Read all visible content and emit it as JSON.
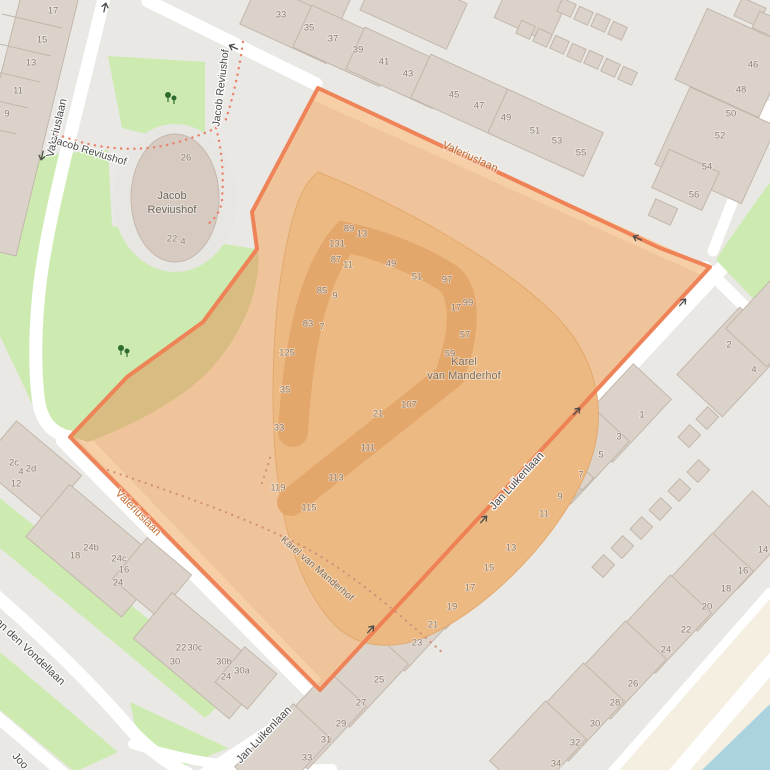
{
  "map": {
    "description": "OpenStreetMap-style map with orange highlighted area Karel van Manderhof",
    "highlighted_area_name": "Karel van Manderhof",
    "colors": {
      "background": "#e9e8e4",
      "building": "#dbd2ca",
      "building_outline": "#c3b7ab",
      "green_area": "#cdebb0",
      "water": "#aad3df",
      "road": "#ffffff",
      "cream_landuse": "#f4efe1",
      "highlight_fill": "#f0c49a",
      "highlight_parcel": "#edb983",
      "highlight_building": "#e3a76c",
      "highlight_border": "#ee7e52",
      "footpath_dots": "#e8826b",
      "street_label": "#4a4a4a",
      "street_label_highlighted": "#c06a2c",
      "house_number": "#8e7d6b"
    },
    "street_labels": {
      "valeriuslaan_west": "Valeriuslaan",
      "valeriuslaan_top": "Valeriuslaan",
      "valeriuslaan_southwest": "Valeriuslaan",
      "jacob_reviushof_path": "Jacob Reviushof",
      "jacob_reviushof_path_vertical": "Jacob Reviushof",
      "jan_luikenlaan_northeast": "Jan Luikenlaan",
      "jan_luikenlaan_south": "Jan Luikenlaan",
      "an_den_vondellaan": "an den Vondellaan",
      "joost_partial": "Joo"
    },
    "place_labels": {
      "jacob_reviushof": {
        "line1": "Jacob",
        "line2": "Reviushof"
      },
      "karel_van_manderhof": {
        "line1": "Karel",
        "line2": "van Manderhof"
      },
      "karel_van_manderhof_path": "Karel van Manderhof"
    },
    "house_numbers": [
      {
        "t": "17",
        "x": 53,
        "y": 11
      },
      {
        "t": "15",
        "x": 42,
        "y": 40
      },
      {
        "t": "13",
        "x": 31,
        "y": 63
      },
      {
        "t": "11",
        "x": 18,
        "y": 91
      },
      {
        "t": "9",
        "x": 7,
        "y": 114
      },
      {
        "t": "33",
        "x": 281,
        "y": 15
      },
      {
        "t": "35",
        "x": 309,
        "y": 28
      },
      {
        "t": "37",
        "x": 333,
        "y": 39
      },
      {
        "t": "39",
        "x": 358,
        "y": 50
      },
      {
        "t": "41",
        "x": 384,
        "y": 62
      },
      {
        "t": "43",
        "x": 408,
        "y": 74
      },
      {
        "t": "45",
        "x": 454,
        "y": 95
      },
      {
        "t": "47",
        "x": 479,
        "y": 106
      },
      {
        "t": "49",
        "x": 506,
        "y": 118
      },
      {
        "t": "51",
        "x": 535,
        "y": 131
      },
      {
        "t": "53",
        "x": 557,
        "y": 141
      },
      {
        "t": "55",
        "x": 581,
        "y": 153
      },
      {
        "t": "46",
        "x": 753,
        "y": 65
      },
      {
        "t": "48",
        "x": 741,
        "y": 90
      },
      {
        "t": "50",
        "x": 731,
        "y": 114
      },
      {
        "t": "52",
        "x": 720,
        "y": 136
      },
      {
        "t": "54",
        "x": 707,
        "y": 167
      },
      {
        "t": "56",
        "x": 694,
        "y": 195
      },
      {
        "t": "26",
        "x": 186,
        "y": 158
      },
      {
        "t": "22",
        "x": 172,
        "y": 239
      },
      {
        "t": "4",
        "x": 183,
        "y": 242
      },
      {
        "t": "89",
        "x": 349,
        "y": 229
      },
      {
        "t": "13",
        "x": 362,
        "y": 234
      },
      {
        "t": "131",
        "x": 337,
        "y": 244
      },
      {
        "t": "87",
        "x": 336,
        "y": 260
      },
      {
        "t": "11",
        "x": 348,
        "y": 265
      },
      {
        "t": "49",
        "x": 391,
        "y": 264
      },
      {
        "t": "51",
        "x": 417,
        "y": 277
      },
      {
        "t": "97",
        "x": 447,
        "y": 280
      },
      {
        "t": "99",
        "x": 468,
        "y": 303
      },
      {
        "t": "17",
        "x": 456,
        "y": 308
      },
      {
        "t": "85",
        "x": 322,
        "y": 291
      },
      {
        "t": "9",
        "x": 335,
        "y": 296
      },
      {
        "t": "57",
        "x": 465,
        "y": 335
      },
      {
        "t": "83",
        "x": 308,
        "y": 324
      },
      {
        "t": "7",
        "x": 322,
        "y": 327
      },
      {
        "t": "125",
        "x": 287,
        "y": 353
      },
      {
        "t": "59",
        "x": 450,
        "y": 354
      },
      {
        "t": "35",
        "x": 285,
        "y": 390
      },
      {
        "t": "33",
        "x": 279,
        "y": 428
      },
      {
        "t": "107",
        "x": 409,
        "y": 405
      },
      {
        "t": "21",
        "x": 378,
        "y": 414
      },
      {
        "t": "111",
        "x": 368,
        "y": 448
      },
      {
        "t": "113",
        "x": 336,
        "y": 478
      },
      {
        "t": "119",
        "x": 278,
        "y": 488
      },
      {
        "t": "115",
        "x": 309,
        "y": 508
      },
      {
        "t": "2c",
        "x": 14,
        "y": 463
      },
      {
        "t": "4",
        "x": 21,
        "y": 472
      },
      {
        "t": "2d",
        "x": 31,
        "y": 469
      },
      {
        "t": "12",
        "x": 16,
        "y": 484
      },
      {
        "t": "24b",
        "x": 91,
        "y": 548
      },
      {
        "t": "18",
        "x": 75,
        "y": 556
      },
      {
        "t": "24c",
        "x": 119,
        "y": 559
      },
      {
        "t": "16",
        "x": 124,
        "y": 570
      },
      {
        "t": "24",
        "x": 118,
        "y": 583
      },
      {
        "t": "22",
        "x": 181,
        "y": 648
      },
      {
        "t": "30c",
        "x": 195,
        "y": 648
      },
      {
        "t": "30",
        "x": 175,
        "y": 662
      },
      {
        "t": "30b",
        "x": 224,
        "y": 662
      },
      {
        "t": "30a",
        "x": 242,
        "y": 671
      },
      {
        "t": "24",
        "x": 226,
        "y": 677
      },
      {
        "t": "2",
        "x": 729,
        "y": 345
      },
      {
        "t": "4",
        "x": 754,
        "y": 370
      },
      {
        "t": "1",
        "x": 642,
        "y": 415
      },
      {
        "t": "3",
        "x": 619,
        "y": 437
      },
      {
        "t": "5",
        "x": 601,
        "y": 455
      },
      {
        "t": "7",
        "x": 581,
        "y": 475
      },
      {
        "t": "9",
        "x": 560,
        "y": 497
      },
      {
        "t": "11",
        "x": 544,
        "y": 514
      },
      {
        "t": "13",
        "x": 511,
        "y": 548
      },
      {
        "t": "15",
        "x": 489,
        "y": 568
      },
      {
        "t": "17",
        "x": 470,
        "y": 588
      },
      {
        "t": "19",
        "x": 452,
        "y": 607
      },
      {
        "t": "21",
        "x": 433,
        "y": 625
      },
      {
        "t": "23",
        "x": 417,
        "y": 643
      },
      {
        "t": "25",
        "x": 379,
        "y": 680
      },
      {
        "t": "27",
        "x": 361,
        "y": 703
      },
      {
        "t": "29",
        "x": 341,
        "y": 724
      },
      {
        "t": "31",
        "x": 326,
        "y": 740
      },
      {
        "t": "33",
        "x": 307,
        "y": 758
      },
      {
        "t": "14",
        "x": 763,
        "y": 550
      },
      {
        "t": "16",
        "x": 743,
        "y": 571
      },
      {
        "t": "18",
        "x": 726,
        "y": 589
      },
      {
        "t": "20",
        "x": 707,
        "y": 607
      },
      {
        "t": "22",
        "x": 686,
        "y": 630
      },
      {
        "t": "24",
        "x": 666,
        "y": 650
      },
      {
        "t": "26",
        "x": 633,
        "y": 684
      },
      {
        "t": "28",
        "x": 615,
        "y": 703
      },
      {
        "t": "30",
        "x": 595,
        "y": 724
      },
      {
        "t": "32",
        "x": 575,
        "y": 743
      },
      {
        "t": "34",
        "x": 556,
        "y": 764
      }
    ],
    "oneway_arrows": [
      {
        "x": 105,
        "y": 7,
        "angle": -77
      },
      {
        "x": 233,
        "y": 47,
        "angle": 205
      },
      {
        "x": 42,
        "y": 156,
        "angle": 103
      },
      {
        "x": 637,
        "y": 238,
        "angle": 205
      },
      {
        "x": 683,
        "y": 302,
        "angle": -48
      },
      {
        "x": 577,
        "y": 411,
        "angle": -48
      },
      {
        "x": 484,
        "y": 519,
        "angle": -48
      },
      {
        "x": 371,
        "y": 629,
        "angle": -48
      }
    ],
    "trees": [
      {
        "x": 170,
        "y": 97
      },
      {
        "x": 123,
        "y": 350
      }
    ]
  }
}
